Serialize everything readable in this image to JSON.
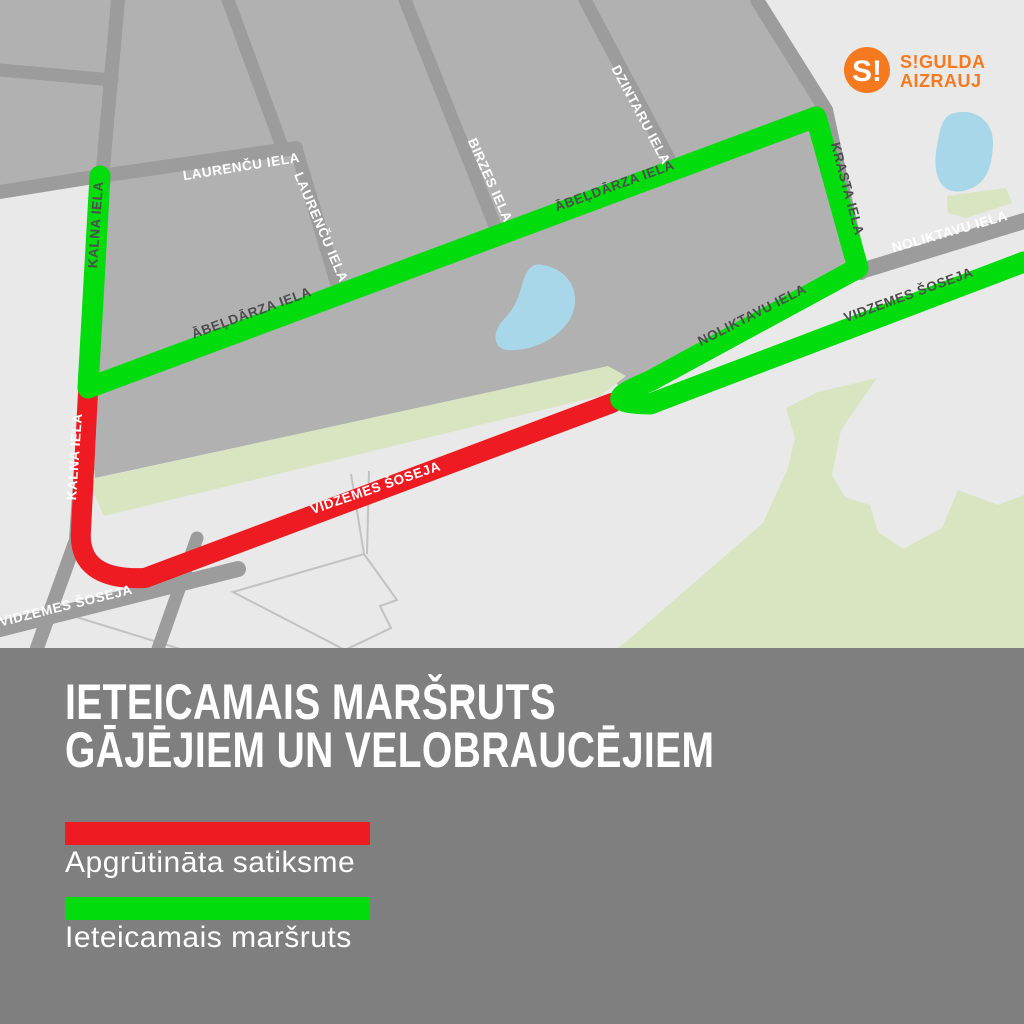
{
  "logo": {
    "mark": "S!",
    "line1": "S!GULDA",
    "line2": "AIZRAUJ",
    "orange": "#f5791f"
  },
  "map": {
    "colors": {
      "background_light": "#e9e9e9",
      "city_block_gray": "#b1b1b1",
      "street_gray": "#9c9c9c",
      "park_green": "#d8e5c0",
      "water_blue": "#a9d7ea",
      "route_recommended_green": "#00dc0c",
      "route_restricted_red": "#ee1b22",
      "label_dark": "#4d4d4d",
      "label_white": "#ffffff"
    },
    "street_labels": [
      {
        "id": "kalna-on-green",
        "text": "KALNA IELA"
      },
      {
        "id": "kalna-on-red",
        "text": "KALNA IELA"
      },
      {
        "id": "laurencu-horizontal",
        "text": "LAURENČU IELA"
      },
      {
        "id": "laurencu-vertical",
        "text": "LAURENČU IELA"
      },
      {
        "id": "birzes",
        "text": "BIRZES IELA"
      },
      {
        "id": "dzintaru",
        "text": "DZINTARU IELA"
      },
      {
        "id": "abeldarza-west",
        "text": "ĀBEĻDĀRZA IELA"
      },
      {
        "id": "abeldarza-east",
        "text": "ĀBEĻDĀRZA IELA"
      },
      {
        "id": "krasta",
        "text": "KRASTA IELA"
      },
      {
        "id": "noliktavu-on-green",
        "text": "NOLIKTAVU IELA"
      },
      {
        "id": "noliktavu-on-gray",
        "text": "NOLIKTAVU IELA"
      },
      {
        "id": "vidzemes-on-green",
        "text": "VIDZEMES ŠOSEJA"
      },
      {
        "id": "vidzemes-on-red",
        "text": "VIDZEMES ŠOSEJA"
      },
      {
        "id": "vidzemes-on-gray",
        "text": "VIDZEMES ŠOSEJA"
      }
    ]
  },
  "footer": {
    "panel_gray": "#7f7f7f",
    "title_line1": "IETEICAMAIS MARŠRUTS",
    "title_line2": "GĀJĒJIEM UN VELOBRAUCĒJIEM",
    "legend": [
      {
        "color": "#ee1b22",
        "label": "Apgrūtināta satiksme"
      },
      {
        "color": "#00dc0c",
        "label": "Ieteicamais maršruts"
      }
    ]
  }
}
